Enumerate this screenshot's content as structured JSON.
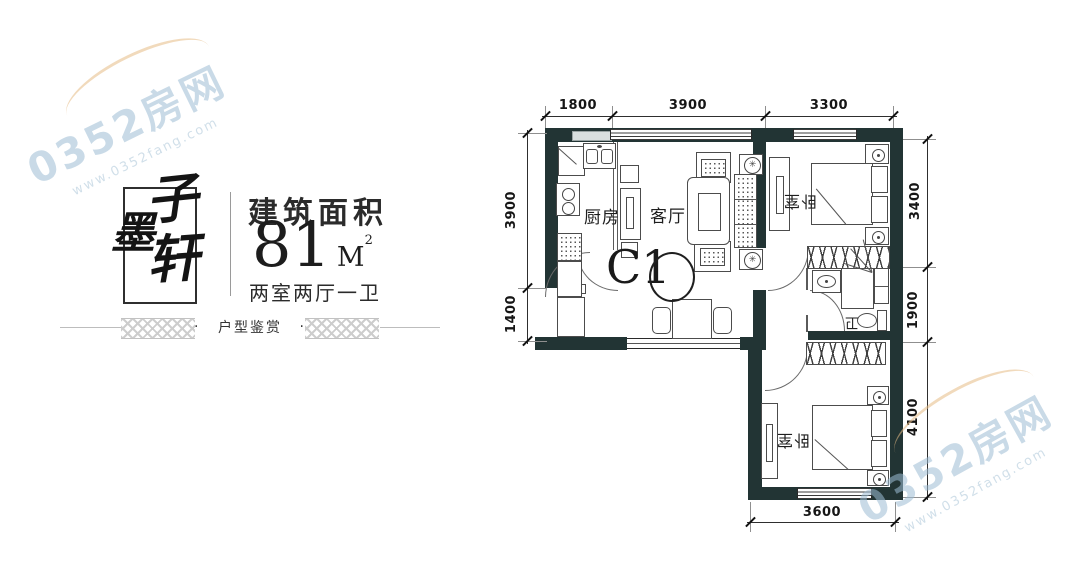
{
  "brand": {
    "char_top": "子",
    "char_mid": "墨",
    "char_btm": "轩"
  },
  "info": {
    "area_label": "建筑面积",
    "area_number": "81",
    "area_unit": "M",
    "area_exp": "2",
    "rooms_summary": "两室两厅一卫",
    "banner_dot": "·",
    "banner_title": "户型鉴赏"
  },
  "watermark": {
    "name": "0352房网",
    "site": "www.0352fang.com"
  },
  "plan": {
    "unit_label": "C1",
    "rooms": {
      "kitchen": "厨房",
      "living": "客厅",
      "bedroom_top": "卧室",
      "bath": "卫",
      "bedroom_bottom": "卧室"
    },
    "dims": {
      "top": [
        "1800",
        "3900",
        "3300"
      ],
      "left": [
        "3900",
        "1400"
      ],
      "right": [
        "3400",
        "1900",
        "4100"
      ],
      "bottom": [
        "3600"
      ]
    }
  },
  "icons": {
    "plant": "✳"
  },
  "colors": {
    "wall": "#223434",
    "watermark_blue": "#9dbdd4",
    "watermark_orange": "#e7bc86"
  }
}
